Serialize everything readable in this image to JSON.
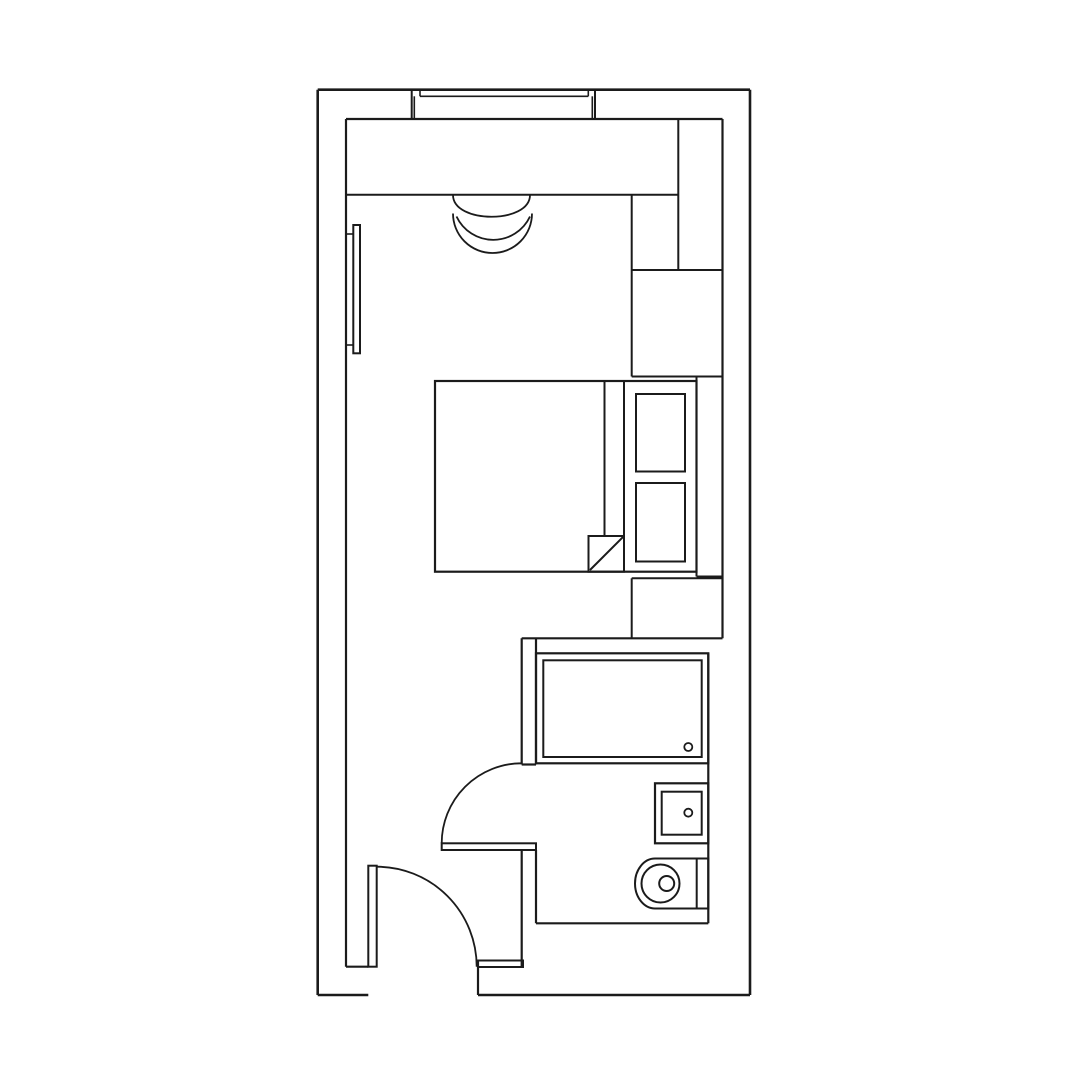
{
  "page": {
    "background": "#ffffff",
    "ink": "#1b1b1b",
    "canvas_width": 1080,
    "canvas_height": 1080
  },
  "floorplan": {
    "description_names": {
      "drawing": "hotel-room-floor-plan",
      "rooms": [
        "main-room",
        "bathroom",
        "entry"
      ]
    },
    "lines": [
      {
        "name": "outer-wall-top",
        "x1": 317.7,
        "y1": 89.7,
        "x2": 750,
        "y2": 89.7,
        "w": 2.6
      },
      {
        "name": "outer-wall-right",
        "x1": 750,
        "y1": 89.7,
        "x2": 750,
        "y2": 995,
        "w": 2.6
      },
      {
        "name": "outer-wall-left",
        "x1": 317.7,
        "y1": 89.7,
        "x2": 317.7,
        "y2": 995,
        "w": 2.6
      },
      {
        "name": "outer-wall-bottom-left-segment",
        "x1": 317.7,
        "y1": 995,
        "x2": 368.3,
        "y2": 995,
        "w": 2.6
      },
      {
        "name": "outer-wall-bottom-right-segment",
        "x1": 478,
        "y1": 995,
        "x2": 750,
        "y2": 995,
        "w": 2.6
      },
      {
        "name": "inner-wall-top",
        "x1": 346,
        "y1": 119,
        "x2": 722.5,
        "y2": 119,
        "w": 2.2
      },
      {
        "name": "inner-wall-left",
        "x1": 346,
        "y1": 119,
        "x2": 346,
        "y2": 966.7,
        "w": 2.2
      },
      {
        "name": "inner-wall-right",
        "x1": 722.5,
        "y1": 119,
        "x2": 722.5,
        "y2": 638.3,
        "w": 2.2
      },
      {
        "name": "inner-wall-bottom",
        "x1": 346,
        "y1": 966.7,
        "x2": 368.3,
        "y2": 966.7,
        "w": 2.2
      },
      {
        "name": "entry-door-right-jamb",
        "x1": 478,
        "y1": 960.5,
        "x2": 478,
        "y2": 995,
        "w": 2.2
      },
      {
        "name": "bathroom-partition-left-upper",
        "x1": 521.7,
        "y1": 638.3,
        "x2": 521.7,
        "y2": 764.5,
        "w": 2.2
      },
      {
        "name": "bathroom-partition-right-upper",
        "x1": 536,
        "y1": 638.3,
        "x2": 536,
        "y2": 764.5,
        "w": 2.2
      },
      {
        "name": "bathroom-partition-cap",
        "x1": 521.7,
        "y1": 764.5,
        "x2": 536,
        "y2": 764.5,
        "w": 2.2
      },
      {
        "name": "bathroom-partition-left-lower",
        "x1": 521.7,
        "y1": 850,
        "x2": 521.7,
        "y2": 966.7,
        "w": 2.2
      },
      {
        "name": "bathroom-partition-right-lower",
        "x1": 536,
        "y1": 850,
        "x2": 536,
        "y2": 923.3,
        "w": 2.2
      },
      {
        "name": "bathroom-top-wall",
        "x1": 521.7,
        "y1": 638.3,
        "x2": 722.5,
        "y2": 638.3,
        "w": 2.2
      },
      {
        "name": "bathroom-bottom-wall",
        "x1": 536,
        "y1": 923.3,
        "x2": 708.3,
        "y2": 923.3,
        "w": 2.2
      },
      {
        "name": "bathroom-right-wall",
        "x1": 708.3,
        "y1": 653.3,
        "x2": 708.3,
        "y2": 923.3,
        "w": 2.2
      },
      {
        "name": "window-left-jamb",
        "x1": 411.7,
        "y1": 90,
        "x2": 411.7,
        "y2": 119,
        "w": 2
      },
      {
        "name": "window-right-jamb",
        "x1": 595,
        "y1": 90,
        "x2": 595,
        "y2": 119,
        "w": 2
      },
      {
        "name": "window-sill-line",
        "x1": 420,
        "y1": 96.3,
        "x2": 588.3,
        "y2": 96.3,
        "w": 1.6
      },
      {
        "name": "window-sill-tick-left",
        "x1": 420,
        "y1": 90,
        "x2": 420,
        "y2": 96.3,
        "w": 1.6
      },
      {
        "name": "window-sill-tick-right",
        "x1": 588.3,
        "y1": 90,
        "x2": 588.3,
        "y2": 96.3,
        "w": 1.6
      },
      {
        "name": "window-glass-left",
        "x1": 414.3,
        "y1": 96.3,
        "x2": 414.3,
        "y2": 119,
        "w": 1.6
      },
      {
        "name": "window-glass-right",
        "x1": 592.3,
        "y1": 96.3,
        "x2": 592.3,
        "y2": 119,
        "w": 1.6
      },
      {
        "name": "desk-front-edge",
        "x1": 346,
        "y1": 194.7,
        "x2": 678.3,
        "y2": 194.7,
        "w": 2
      },
      {
        "name": "wardrobe-left-edge",
        "x1": 678.3,
        "y1": 119,
        "x2": 678.3,
        "y2": 270,
        "w": 2
      },
      {
        "name": "wardrobe-bottom-edge",
        "x1": 631.7,
        "y1": 270,
        "x2": 722.5,
        "y2": 270,
        "w": 2
      },
      {
        "name": "cabinet-left-edge",
        "x1": 631.7,
        "y1": 194.7,
        "x2": 631.7,
        "y2": 376.5,
        "w": 2
      },
      {
        "name": "cabinet-bottom-edge",
        "x1": 631.7,
        "y1": 376.5,
        "x2": 722.5,
        "y2": 376.5,
        "w": 2
      },
      {
        "name": "bed-pillow-divider",
        "x1": 624,
        "y1": 381,
        "x2": 624,
        "y2": 571.7,
        "w": 2
      },
      {
        "name": "duvet-edge-line",
        "x1": 604.5,
        "y1": 381,
        "x2": 604.5,
        "y2": 536,
        "w": 2
      },
      {
        "name": "duvet-fold-diagonal",
        "x1": 590,
        "y1": 570,
        "x2": 623.3,
        "y2": 536.7,
        "w": 2
      },
      {
        "name": "headboard-right-edge",
        "x1": 696.5,
        "y1": 376.5,
        "x2": 696.5,
        "y2": 576.5,
        "w": 2
      },
      {
        "name": "bed-side-ledge-cap",
        "x1": 696.5,
        "y1": 576.5,
        "x2": 722.5,
        "y2": 576.5,
        "w": 2
      },
      {
        "name": "nightstand-top-edge",
        "x1": 631.7,
        "y1": 578.3,
        "x2": 722.5,
        "y2": 578.3,
        "w": 2
      },
      {
        "name": "nightstand-left-edge",
        "x1": 631.7,
        "y1": 578.3,
        "x2": 631.7,
        "y2": 638.3,
        "w": 2
      },
      {
        "name": "tv-bracket-top",
        "x1": 346,
        "y1": 234,
        "x2": 353.3,
        "y2": 234,
        "w": 1.6
      },
      {
        "name": "tv-bracket-bottom",
        "x1": 346,
        "y1": 345,
        "x2": 353.3,
        "y2": 345,
        "w": 1.6
      }
    ],
    "rects": [
      {
        "name": "entry-wall-stub",
        "x": 478,
        "y": 960.5,
        "w": 45,
        "h": 6.5,
        "sw": 2
      },
      {
        "name": "wall-tv-panel",
        "x": 353.3,
        "y": 225,
        "w": 6.7,
        "h": 128.3,
        "sw": 2
      },
      {
        "name": "bed-outline",
        "x": 435,
        "y": 381,
        "w": 261.5,
        "h": 190.7,
        "sw": 2.2
      },
      {
        "name": "duvet-fold-square",
        "x": 588.5,
        "y": 536,
        "w": 35.5,
        "h": 35.7,
        "sw": 2
      },
      {
        "name": "pillow-top",
        "x": 636,
        "y": 394,
        "w": 49,
        "h": 77.5,
        "sw": 2
      },
      {
        "name": "pillow-bottom",
        "x": 636,
        "y": 483,
        "w": 49,
        "h": 78.5,
        "sw": 2
      },
      {
        "name": "shower-tray-outer",
        "x": 536,
        "y": 653.3,
        "w": 172.3,
        "h": 110,
        "sw": 2.2
      },
      {
        "name": "shower-tray-inner",
        "x": 543.3,
        "y": 660.3,
        "w": 158.4,
        "h": 96.7,
        "sw": 2
      },
      {
        "name": "sink-counter-outer",
        "x": 655,
        "y": 783.3,
        "w": 53.3,
        "h": 60,
        "sw": 2.2
      },
      {
        "name": "sink-basin-inner",
        "x": 661.7,
        "y": 791.7,
        "w": 40,
        "h": 43,
        "sw": 2
      },
      {
        "name": "toilet-tank",
        "x": 696.7,
        "y": 858.5,
        "w": 11.6,
        "h": 50,
        "sw": 2
      },
      {
        "name": "entry-door-leaf",
        "x": 368.3,
        "y": 865.7,
        "w": 8.4,
        "h": 101,
        "sw": 2
      },
      {
        "name": "bathroom-door-leaf",
        "x": 441.7,
        "y": 843.3,
        "w": 94.3,
        "h": 6.7,
        "sw": 2
      }
    ],
    "circles": [
      {
        "name": "shower-drain",
        "cx": 688.3,
        "cy": 747,
        "r": 4,
        "sw": 1.8
      },
      {
        "name": "sink-drain",
        "cx": 688.3,
        "cy": 812.7,
        "r": 4,
        "sw": 1.8
      },
      {
        "name": "toilet-bowl-outer",
        "cx": 660.5,
        "cy": 883.5,
        "r": 19,
        "sw": 2
      },
      {
        "name": "toilet-bowl-inner",
        "cx": 666.7,
        "cy": 883.5,
        "r": 7.5,
        "sw": 2
      }
    ],
    "paths": [
      {
        "name": "desk-chair-seat",
        "d": "M 453 195 C 453 224 530 224 530 195",
        "sw": 1.8
      },
      {
        "name": "desk-chair-back-outer",
        "d": "M 453 213.5 A 39.5 39.5 0 0 0 532 213.5",
        "sw": 1.8
      },
      {
        "name": "desk-chair-back-inner",
        "d": "M 456.5 216.5 A 40.6 40.6 0 0 0 530 216.5",
        "sw": 1.8
      },
      {
        "name": "toilet-body",
        "d": "M 696.7 858.5 L 655 858.5 A 20 25 0 0 0 655 908.5 L 696.7 908.5",
        "sw": 2
      },
      {
        "name": "entry-door-swing-arc",
        "d": "M 376.7 866.7 A 100 100 0 0 1 476.7 966.7",
        "sw": 1.8
      },
      {
        "name": "bathroom-door-swing-arc",
        "d": "M 441.7 843.3 A 80 80 0 0 1 521.7 763.3",
        "sw": 1.8
      }
    ]
  }
}
